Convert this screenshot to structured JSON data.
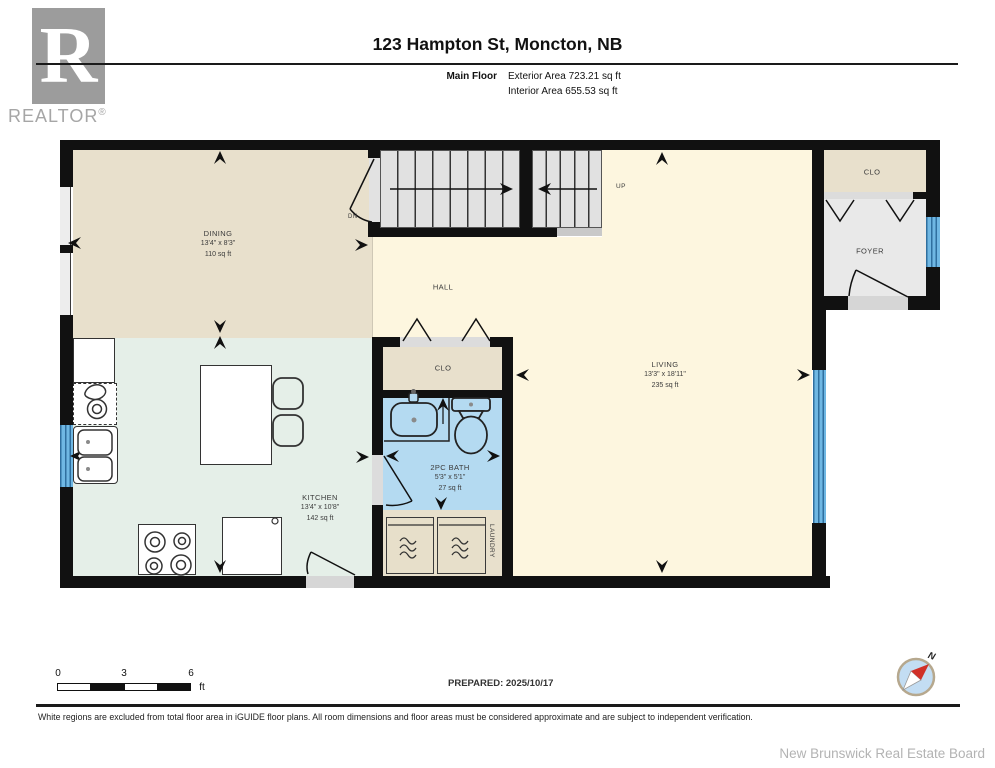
{
  "branding": {
    "logo_letter": "R",
    "logo_text": "REALTOR",
    "registered": "®",
    "board_credit": "New Brunswick Real Estate Board"
  },
  "header": {
    "title": "123 Hampton St, Moncton, NB",
    "floor_label": "Main Floor",
    "exterior_area": "Exterior Area 723.21 sq ft",
    "interior_area": "Interior Area 655.53 sq ft"
  },
  "rooms": {
    "dining": {
      "name": "DINING",
      "dims": "13'4\" x 8'3\"",
      "area": "110 sq ft"
    },
    "kitchen": {
      "name": "KITCHEN",
      "dims": "13'4\" x 10'8\"",
      "area": "142 sq ft"
    },
    "living": {
      "name": "LIVING",
      "dims": "13'3\" x 18'11\"",
      "area": "235 sq ft"
    },
    "bath": {
      "name": "2PC BATH",
      "dims": "5'3\" x 5'1\"",
      "area": "27 sq ft"
    },
    "hall": {
      "name": "HALL"
    },
    "foyer": {
      "name": "FOYER"
    },
    "closet_entry": {
      "name": "CLO"
    },
    "closet_hall": {
      "name": "CLO"
    },
    "laundry": {
      "name": "LAUNDRY"
    }
  },
  "stairs": {
    "up_label": "UP",
    "down_label": "DN"
  },
  "scale_bar": {
    "tick_0": "0",
    "tick_3": "3",
    "tick_6": "6",
    "unit": "ft"
  },
  "compass": {
    "north_label": "N"
  },
  "footer": {
    "prepared": "PREPARED: 2025/10/17",
    "disclaimer": "White regions are excluded from total floor area in iGUIDE floor plans. All room dimensions and floor areas must be considered approximate and are subject to independent verification."
  },
  "colors": {
    "wall": "#111111",
    "window_blue": "#58a7d7",
    "floor_dining": "#e8e0cc",
    "floor_hall": "#fdf6df",
    "floor_kitchen": "#e5efe8",
    "floor_bath": "#b4daf1",
    "floor_foyer": "#e9e9e9",
    "floor_closet": "#e8e0cc",
    "stair_tread": "#e1e1e1",
    "compass_needle": "#d03028"
  }
}
